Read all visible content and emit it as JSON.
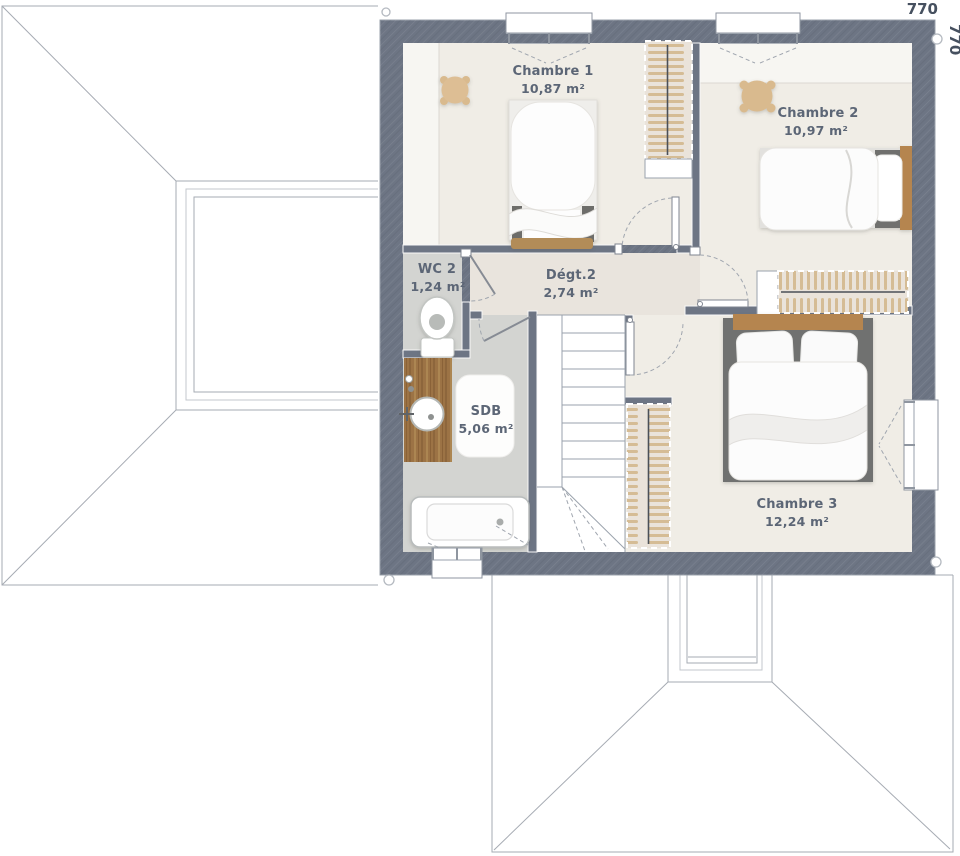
{
  "plan": {
    "type": "floor-plan",
    "dimensions": {
      "width_label": "770",
      "height_label": "770"
    },
    "rooms": [
      {
        "id": "chambre1",
        "name": "Chambre 1",
        "area": "10,87 m²"
      },
      {
        "id": "chambre2",
        "name": "Chambre 2",
        "area": "10,97 m²"
      },
      {
        "id": "wc2",
        "name": "WC 2",
        "area": "1,24 m²"
      },
      {
        "id": "degt2",
        "name": "Dégt.2",
        "area": "2,74 m²"
      },
      {
        "id": "sdb",
        "name": "SDB",
        "area": "5,06 m²"
      },
      {
        "id": "chambre3",
        "name": "Chambre 3",
        "area": "12,24 m²"
      }
    ],
    "furniture_icons": [
      "single-bed",
      "double-bed",
      "double-bed",
      "stool",
      "stool",
      "wardrobe",
      "wardrobe",
      "wardrobe",
      "staircase",
      "toilet",
      "bathtub",
      "vanity-sink",
      "window",
      "door-swing"
    ],
    "colors": {
      "wall": "#6d7584",
      "floor_bedroom": "#f0ede6",
      "floor_low_ceiling": "#f7f6f2",
      "floor_corridor": "#e9e4dd",
      "floor_wet": "#d3d4d1",
      "floor_stairs": "#ffffff",
      "wood_vanity": "#9c7345",
      "wood_headboard": "#b5854f",
      "wood_bench": "#b28c58",
      "closet_bg": "#eae3da",
      "closet_stroke": "#d5bc95",
      "label_text": "#5c6676",
      "dim_text": "#46505f",
      "line": "#9aa2ac"
    }
  }
}
